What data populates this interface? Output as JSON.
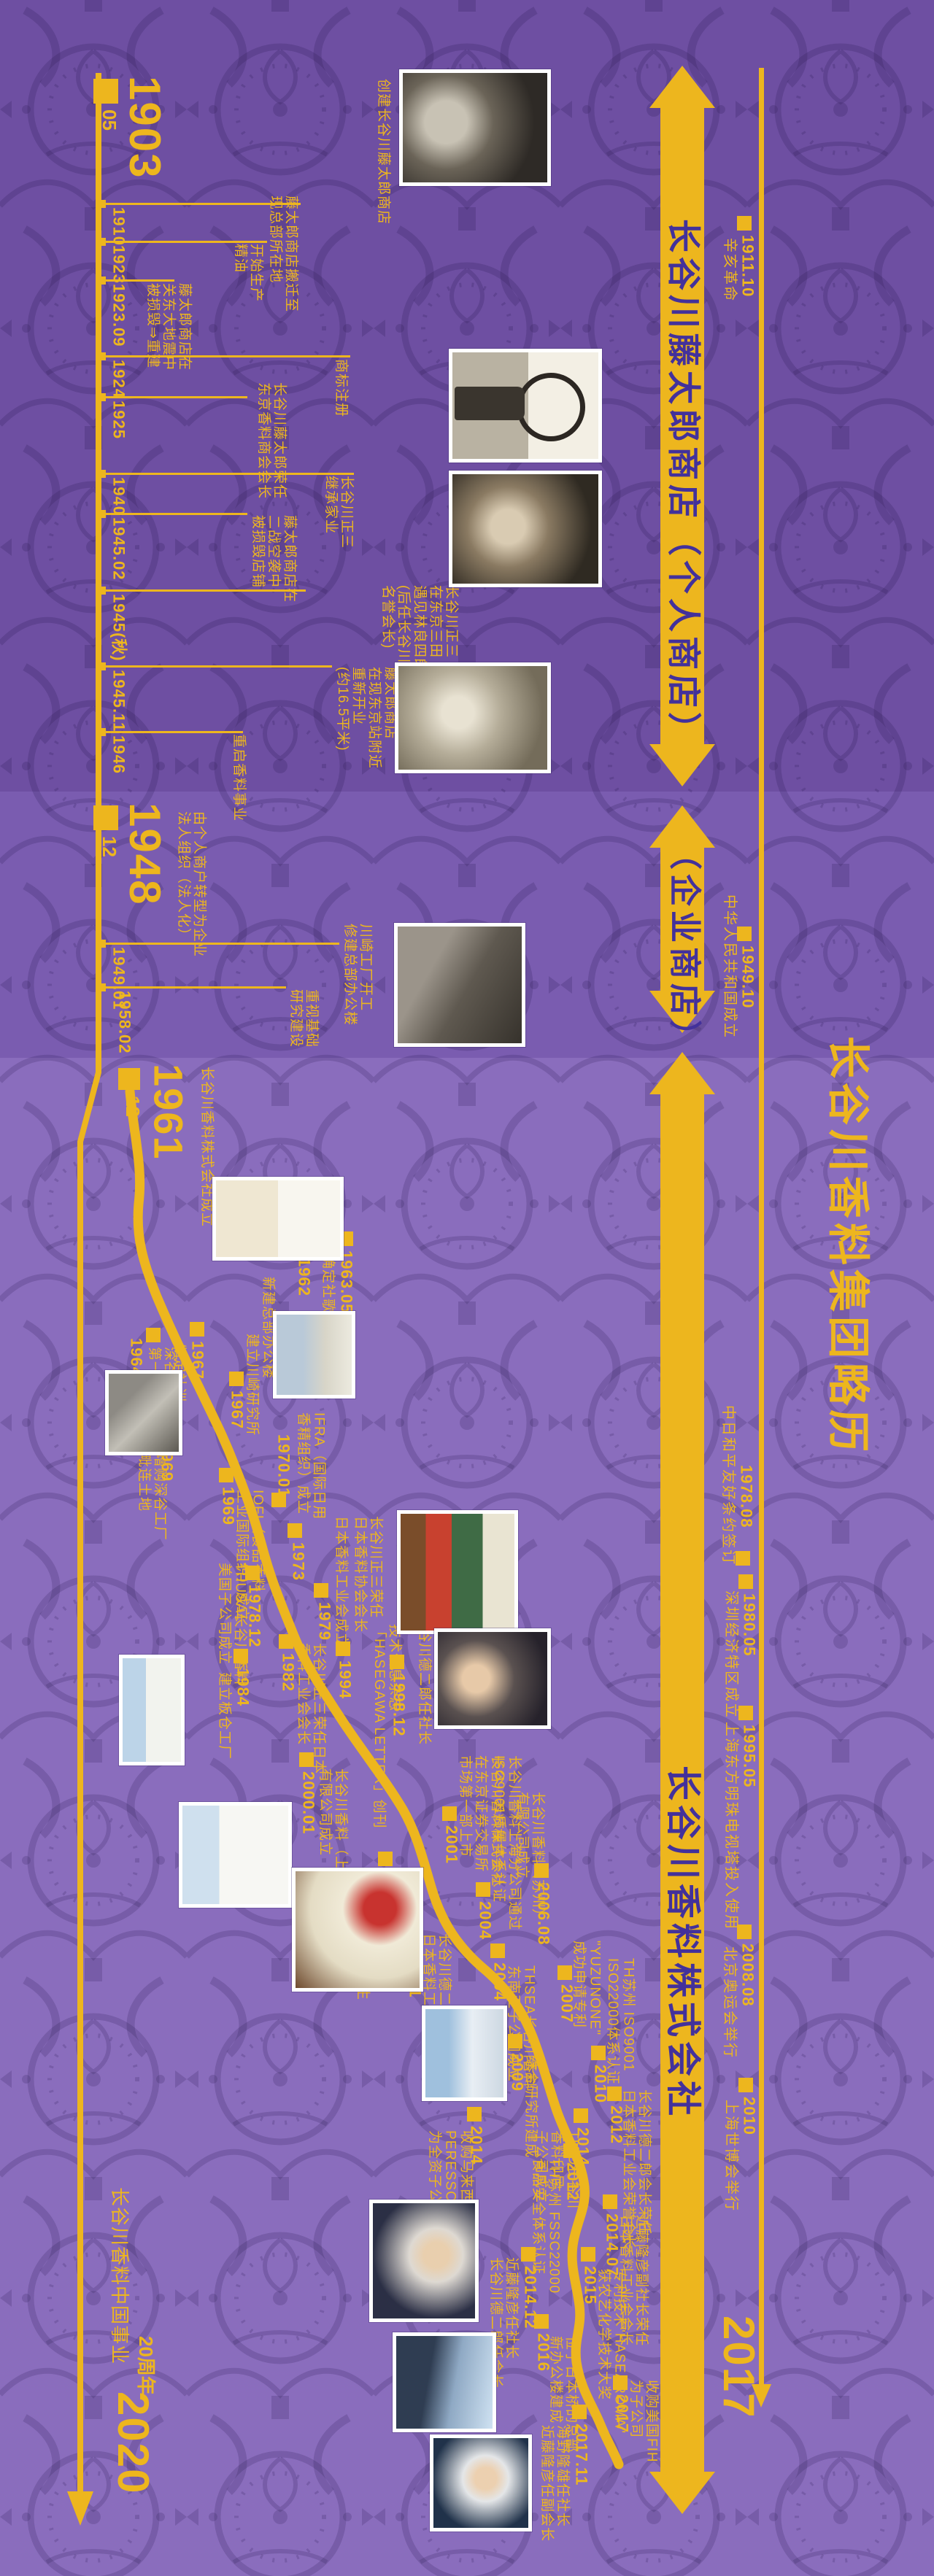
{
  "title": "长谷川香料集团略历",
  "colors": {
    "yellow": "#edb61e",
    "band_top": "#6e4fa2",
    "band_mid": "#7a5cb0",
    "band_bottom": "#8a6dbd",
    "arrow_text": "#43319b"
  },
  "arrows": [
    {
      "label": "长谷川藤太郎商店（个人商店）"
    },
    {
      "label": "（企业商店）"
    },
    {
      "label": "长谷川香料株式会社"
    }
  ],
  "right_end_year": "2017",
  "context_events": [
    {
      "year": "1911.10",
      "desc": "辛亥革命"
    },
    {
      "year": "1949.10",
      "desc": "中华人民共和国成立"
    },
    {
      "year": "1978.08",
      "desc": "中日和平友好条约签订"
    },
    {
      "year": "1980.05",
      "desc": "深圳经济特区成立"
    },
    {
      "year": "1995.05",
      "desc": "上海东方明珠电视塔投入使用"
    },
    {
      "year": "2008.08",
      "desc": "北京奥运会举行"
    },
    {
      "year": "2010",
      "desc": "上海世博会举行"
    }
  ],
  "m1903": {
    "year": "1903",
    "month": "05",
    "desc": "创建长谷川藤太郎商店"
  },
  "m1948": {
    "year": "1948",
    "month": "12",
    "desc": "由个人商户转型为企业\n法人组织（法人化）"
  },
  "m1961": {
    "year": "1961",
    "month": "12",
    "desc": "长谷川香料株式会社成立"
  },
  "left_events": [
    {
      "year": "1910",
      "desc": "藤太郎商店搬迁至\n现总部所在地"
    },
    {
      "year": "1923",
      "desc": "开始生产\n精油"
    },
    {
      "year": "1923.09",
      "desc": "藤太郎商店在\n关东大地震中\n被损毁⇒重建"
    },
    {
      "year": "1924",
      "desc": "商标注册"
    },
    {
      "year": "1925",
      "desc": "长谷川藤太郎荣任\n东京香料商会会长"
    },
    {
      "year": "1940",
      "desc": "长谷川正三\n继承家业"
    },
    {
      "year": "1945.02",
      "desc": "藤太郎商店在\n二战空袭中\n被损毁店铺"
    },
    {
      "year": "1945(秋)",
      "desc": "长谷川正三\n在东京三田\n遇见林良四郎\n(后任长谷川香料\n名誉会长)"
    },
    {
      "year": "1945.11",
      "desc": "藤太郎商店\n在现东京站附近\n重新开业\n(约16.5平米)"
    },
    {
      "year": "1946",
      "desc": "重启香料事业"
    },
    {
      "year": "1949.01",
      "desc": "川崎工厂开工\n修建总部办公楼"
    },
    {
      "year": "1958.02",
      "desc": "重视基础\n研究建设"
    }
  ],
  "wavy_events": [
    {
      "year": "1962",
      "desc": "新建总部办公楼"
    },
    {
      "year": "1963.05",
      "desc": "确定社歌"
    },
    {
      "year": "1964.11",
      "desc": "深谷工厂\n第一期投产"
    },
    {
      "year": "1967",
      "desc": "制定社训"
    },
    {
      "year": "1967",
      "desc": "建立川崎研究所"
    },
    {
      "year": "1969",
      "desc": "增购深谷工厂\n毗连土地"
    },
    {
      "year": "1969",
      "desc": "IOFI（食品香料\n工业国际组织）成立"
    },
    {
      "year": "1970.01",
      "desc": "IFRA（国际日用\n香精组织）成立"
    },
    {
      "year": "1973",
      "desc": "日本香料工业会成立"
    },
    {
      "year": "",
      "desc": "长谷川正三荣任\n日本香料协会会长"
    },
    {
      "year": "1978.12",
      "desc": "THUSA长谷川香料\n美国子公司成立"
    },
    {
      "year": "1979",
      "desc": "技术信息杂志\n「HASEGAWA LETTER」创刊"
    },
    {
      "year": "1982",
      "desc": "长谷川正三荣任日本\n香料工业会会长"
    },
    {
      "year": "1984",
      "desc": "建立板仓工厂"
    },
    {
      "year": "1994",
      "desc": "长谷川德二郎任社长"
    },
    {
      "year": "1998.12",
      "desc": "长谷川正三任会长"
    },
    {
      "year": "2000.01",
      "desc": "长谷川香料（上海）\n有限公司成立"
    },
    {
      "year": "2001",
      "desc": "长谷川香料株式会社\n在东京证券交易所\n市场第一部上市"
    },
    {
      "year": "2003.10",
      "desc": "设立「长谷川留学生\n奖学金财团」"
    },
    {
      "year": "2004.01",
      "desc": "长谷川德二郎荣任\n日本香料工业会会长"
    },
    {
      "year": "2004",
      "desc": "长谷川香料上海分公司通过\nISO9001质量体系认证"
    },
    {
      "year": "2004",
      "desc": "THSEA长谷川香料\n东南亚子公司成立"
    },
    {
      "year": "2006.08",
      "desc": "长谷川香料（苏州）\n有限公司成立"
    },
    {
      "year": "2007",
      "desc": "\"YUZUNONE\"\n成功申请专利"
    },
    {
      "year": "2009",
      "desc": "综合研究所建成"
    },
    {
      "year": "2010",
      "desc": "TH苏州 ISO9001\nISO22000体系认证"
    },
    {
      "year": "2012",
      "desc": "长谷川德二郎会长荣任\n日本香料工业会荣誉会长"
    },
    {
      "year": "2012",
      "desc": "TH苏州 FSSC22000\n食品安全体系认证"
    },
    {
      "year": "2014",
      "desc": "THID长谷川\n香料印尼\n子公司成立"
    },
    {
      "year": "2014",
      "desc": "收购马来西亚\nPERESSCOL\n为全资子公司"
    },
    {
      "year": "2014.07",
      "desc": "近藤隆彦副社长荣任\n日本香料工业会会长"
    },
    {
      "year": "2014.12",
      "desc": "近藤隆彦任社长\n长谷川德二郎任会长"
    },
    {
      "year": "2015",
      "desc": "专利技术\"HASEAROMA\"\n获农艺化学技术大奖"
    },
    {
      "year": "2016",
      "desc": "位于日本桥的总部\n新办公楼建成"
    },
    {
      "year": "2017",
      "desc": "收购美国FIH\n为子公司"
    },
    {
      "year": "2017.11",
      "desc": "海野隆雄任社长\n近藤隆彦任副会长"
    }
  ],
  "footer": {
    "line1": "长谷川香料中国事业",
    "line2": "20周年",
    "year": "2020"
  }
}
